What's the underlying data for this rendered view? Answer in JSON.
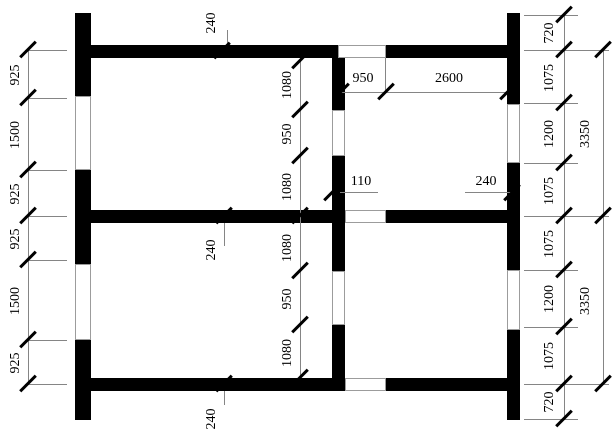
{
  "dims": {
    "left": [
      "925",
      "1500",
      "925",
      "925",
      "1500",
      "925"
    ],
    "interior": [
      "1080",
      "950",
      "1080",
      "1080",
      "950",
      "1080"
    ],
    "right_inner": [
      "720",
      "1075",
      "1200",
      "1075",
      "1075",
      "1200",
      "1075",
      "720"
    ],
    "right_outer": [
      "3350",
      "3350"
    ],
    "top_opening": "950",
    "top_span": "2600",
    "mid_stub": "110",
    "mid_wall": "240",
    "wall_top": "240",
    "wall_middle": "240",
    "wall_bottom": "240"
  }
}
